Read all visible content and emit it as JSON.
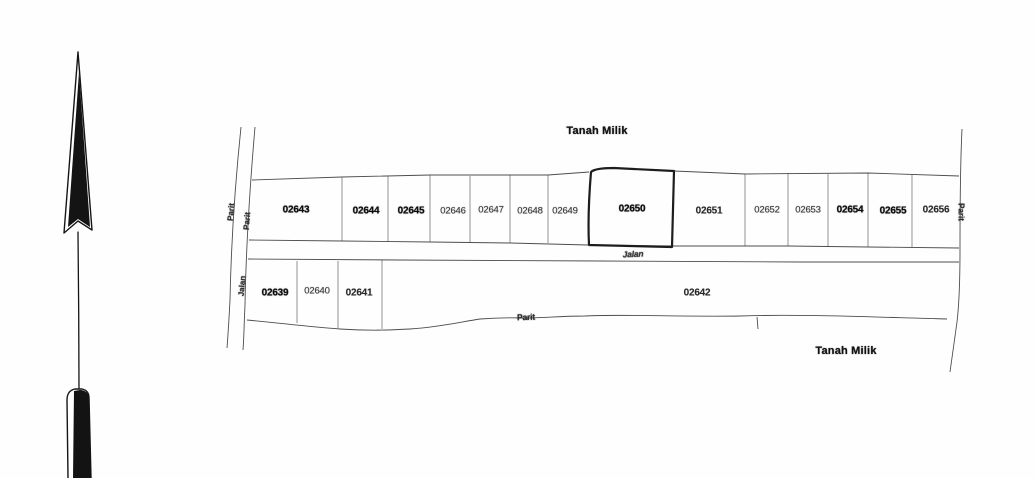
{
  "labels": {
    "tanah_milik_top": "Tanah Milik",
    "tanah_milik_bottom": "Tanah Milik",
    "jalan_center": "Jalan",
    "jalan_left": "Jalan",
    "parit_bottom": "Parit",
    "parit_left_outer": "Parit",
    "parit_left_inner": "Parit",
    "parit_right": "Parit"
  },
  "plots": {
    "upper": [
      {
        "id": "02643"
      },
      {
        "id": "02644"
      },
      {
        "id": "02645"
      },
      {
        "id": "02646"
      },
      {
        "id": "02647"
      },
      {
        "id": "02648"
      },
      {
        "id": "02649"
      },
      {
        "id": "02650"
      },
      {
        "id": "02651"
      },
      {
        "id": "02652"
      },
      {
        "id": "02653"
      },
      {
        "id": "02654"
      },
      {
        "id": "02655"
      },
      {
        "id": "02656"
      }
    ],
    "lower": [
      {
        "id": "02639"
      },
      {
        "id": "02640"
      },
      {
        "id": "02641"
      },
      {
        "id": "02642"
      }
    ]
  },
  "colors": {
    "ink": "#1b1b1b",
    "paper": "#fefefe"
  }
}
